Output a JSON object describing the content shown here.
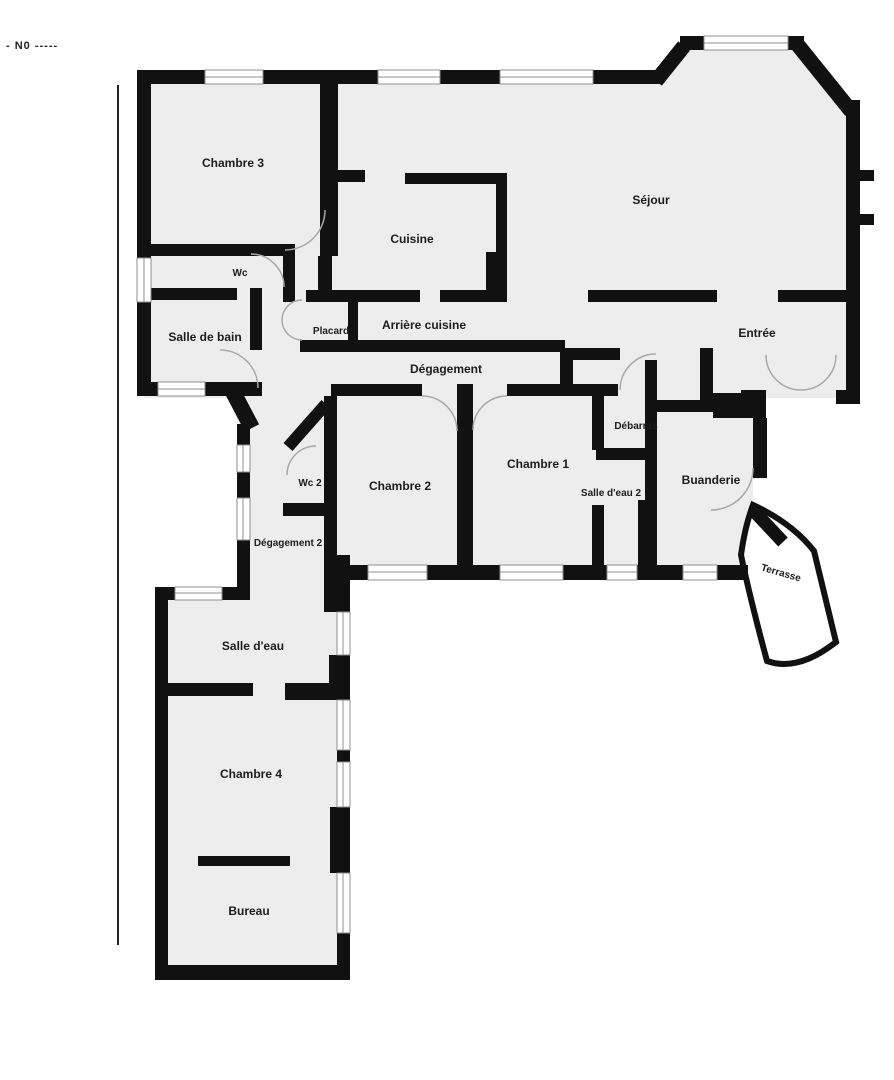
{
  "marker": {
    "text": "-  N0  -----"
  },
  "colors": {
    "wall": "#111111",
    "floor": "#ededed",
    "window_line": "#8f8f8f",
    "door_arc": "#a8a8a8",
    "background": "#ffffff",
    "label": "#1c1c1c"
  },
  "plan": {
    "type": "floor-plan",
    "language": "fr",
    "room_count": 20
  },
  "rooms": [
    {
      "id": "chambre-3",
      "label": "Chambre 3"
    },
    {
      "id": "wc",
      "label": "Wc"
    },
    {
      "id": "salle-de-bain",
      "label": "Salle de bain"
    },
    {
      "id": "cuisine",
      "label": "Cuisine"
    },
    {
      "id": "placard",
      "label": "Placard"
    },
    {
      "id": "arriere-cuisine",
      "label": "Arrière cuisine"
    },
    {
      "id": "degagement",
      "label": "Dégagement"
    },
    {
      "id": "sejour",
      "label": "Séjour"
    },
    {
      "id": "entree",
      "label": "Entrée"
    },
    {
      "id": "debarras",
      "label": "Débarras"
    },
    {
      "id": "chambre-1",
      "label": "Chambre 1"
    },
    {
      "id": "chambre-2",
      "label": "Chambre 2"
    },
    {
      "id": "wc-2",
      "label": "Wc 2"
    },
    {
      "id": "salle-d-eau-2",
      "label": "Salle d'eau 2"
    },
    {
      "id": "buanderie",
      "label": "Buanderie"
    },
    {
      "id": "terrasse",
      "label": "Terrasse"
    },
    {
      "id": "degagement-2",
      "label": "Dégagement 2"
    },
    {
      "id": "salle-d-eau",
      "label": "Salle d'eau"
    },
    {
      "id": "chambre-4",
      "label": "Chambre 4"
    },
    {
      "id": "bureau",
      "label": "Bureau"
    }
  ]
}
